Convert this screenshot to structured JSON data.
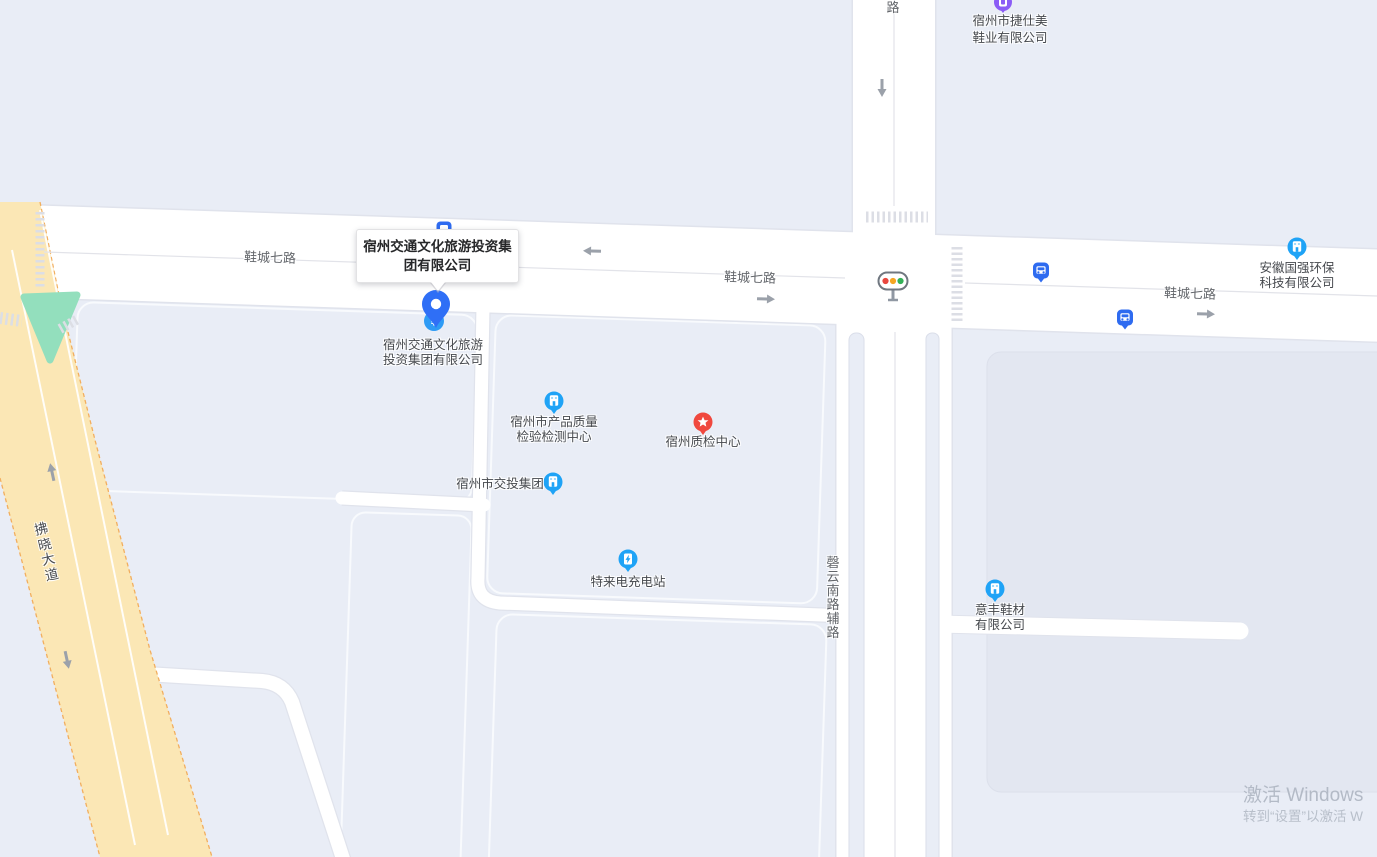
{
  "map_labels": {
    "road_xiecheng": "鞋城七路",
    "road_top_partial": "路",
    "road_qingyun_aux": "磬云南路辅路",
    "road_fuxiao": "拂晓大道"
  },
  "selected_place": {
    "name": "宿州交通文化旅游投资集团有限公司",
    "label_line1": "宿州交通文化旅游",
    "label_line2": "投资集团有限公司",
    "icon": "finance-poi-icon",
    "finance_glyph": "¥"
  },
  "pois": {
    "jieshimei": {
      "line1": "宿州市捷仕美",
      "line2": "鞋业有限公司",
      "icon": "purple-company-pin-icon"
    },
    "guoqiang": {
      "line1": "安徽国强环保",
      "line2": "科技有限公司",
      "icon": "blue-company-poi-icon"
    },
    "zhiliang": {
      "line1": "宿州市产品质量",
      "line2": "检验检测中心",
      "icon": "blue-company-poi-icon"
    },
    "zhijian": {
      "name": "宿州质检中心",
      "icon": "red-star-poi-icon"
    },
    "jiaotou": {
      "name": "宿州市交投集团",
      "icon": "blue-company-poi-icon"
    },
    "teladian": {
      "name": "特来电充电站",
      "icon": "ev-charging-poi-icon"
    },
    "yifeng": {
      "line1": "意丰鞋材",
      "line2": "有限公司",
      "icon": "blue-company-poi-icon"
    }
  },
  "transit": {
    "bus_stop_icon": "bus-stop-icon",
    "traffic_light_icon": "traffic-light-icon"
  },
  "watermark": {
    "line1": "激活 Windows",
    "line2": "转到“设置”以激活 W"
  },
  "colors": {
    "background": "#E9EDF6",
    "road": "#FFFFFF",
    "road_edge": "#E0E3EC",
    "highway_fill": "#FBE7B5",
    "highway_edge": "#F2AE5E",
    "green_area": "#93DFBD",
    "block_dark": "#E3E7F1",
    "poi_blue": "#1FA3F6",
    "transit_blue": "#2E6BF0",
    "poi_red": "#F0483E",
    "poi_purple": "#8B5CF6",
    "pin_blue": "#2F6FF6",
    "light_red": "#E8473F",
    "light_yellow": "#F5A623",
    "light_green": "#33B057"
  }
}
